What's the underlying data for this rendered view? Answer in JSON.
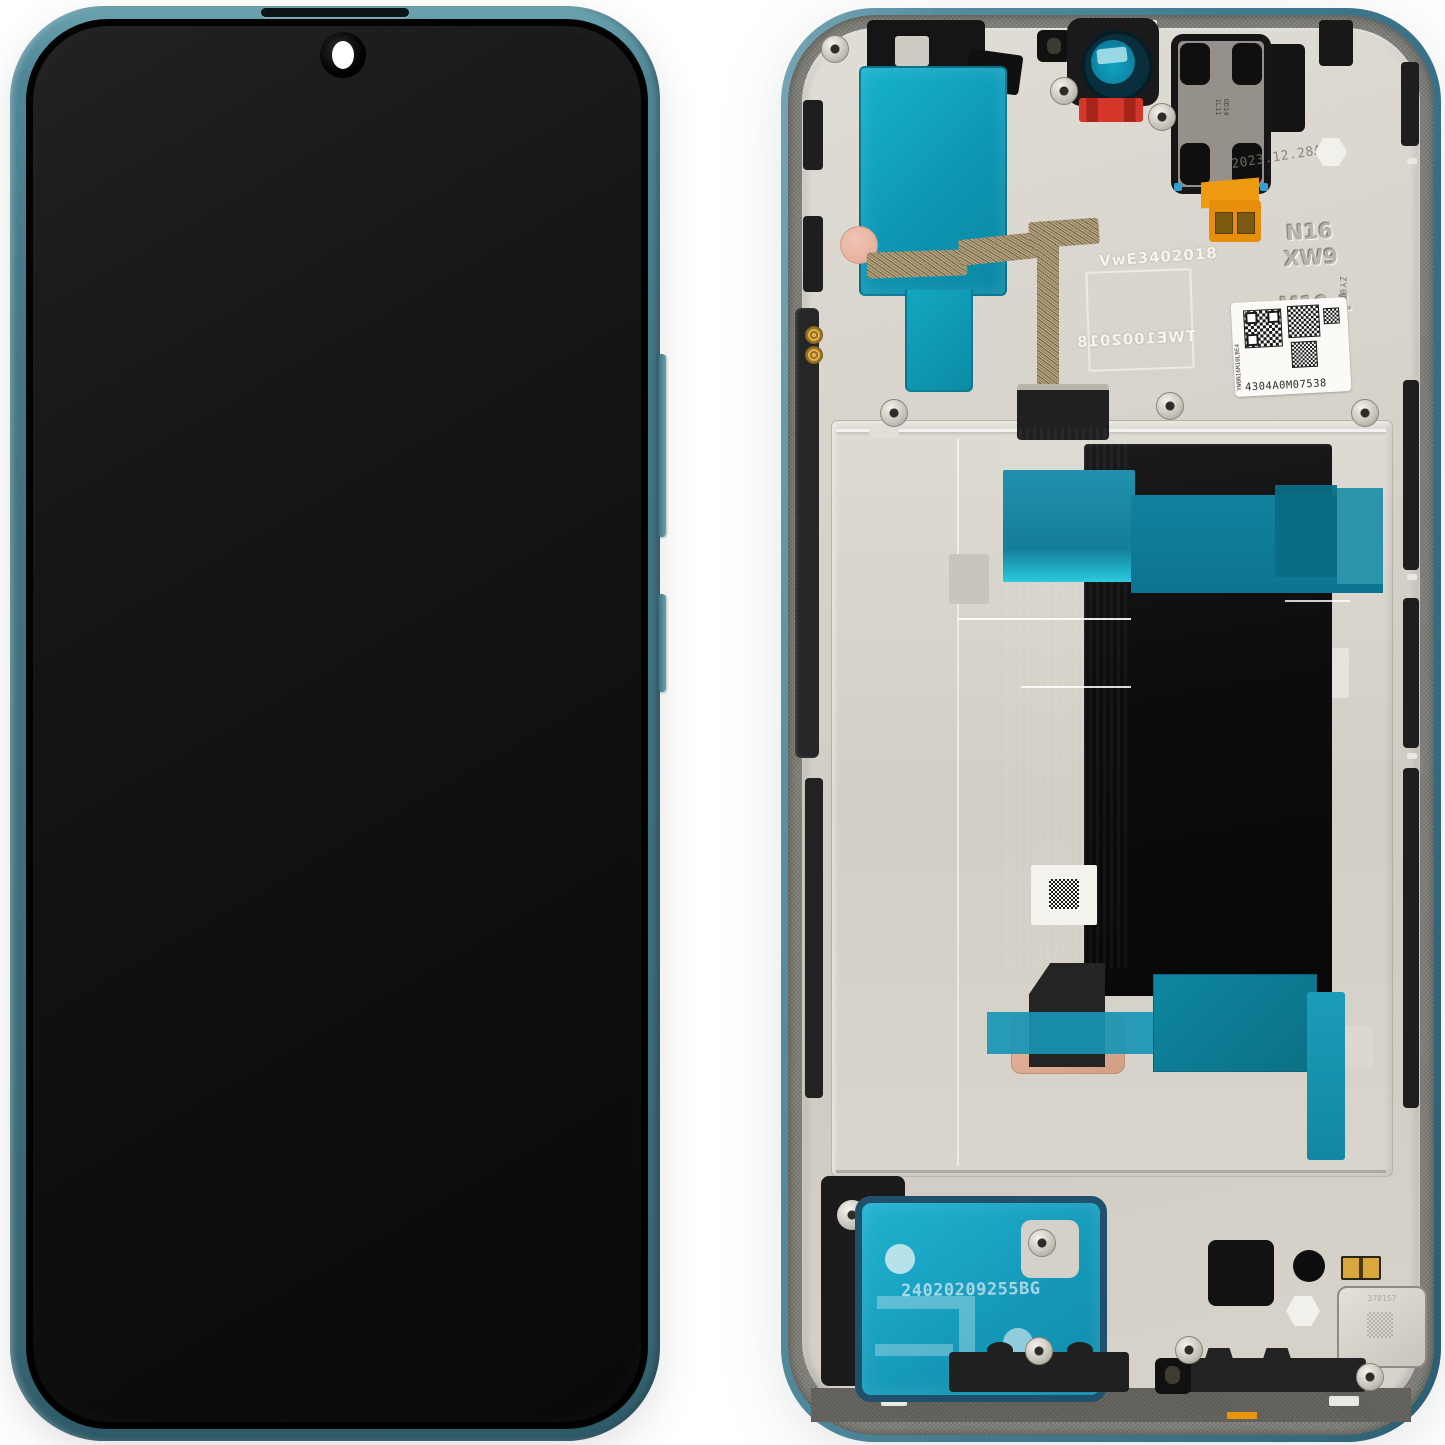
{
  "image": {
    "subject": "Smartphone LCD display assembly with frame, teal color, front and back views",
    "background_color": "#FFFFFF"
  },
  "front_view": {
    "frame_color": "#447583",
    "screen_color": "#0E0E0E",
    "features": [
      "earpiece-slot",
      "punch-hole-camera",
      "volume-button",
      "power-button"
    ]
  },
  "back_view": {
    "markings": {
      "date_stamp": "2023.12.28A",
      "mold_code_line1": "N16",
      "mold_code_line2": "XW9",
      "mold_code_line3": "M10-1",
      "plate_print_top": "VwE3402018",
      "plate_print_bottom_mirrored": "TWE1002018",
      "frame_serial_vertical": "ZY06181272I",
      "qr_sticker_serial": "4304A0M07538",
      "qr_sticker_side_code": "YW0N16M10LBE4",
      "speaker_tape_code": "24020209255BG",
      "earpiece_marking_a": "GD14",
      "earpiece_marking_b": "1L11",
      "vibration_motor_marking": "3701S7"
    },
    "colors": {
      "rim_teal": "#417A90",
      "mid_frame_grey": "#807F79",
      "plate_silver": "#D6D2CA",
      "adhesive_teal_top": "#0FA7C4",
      "adhesive_teal_band": "#10829E",
      "speaker_tape_teal": "#1598B8",
      "tape_border_navy": "#20506B",
      "copper_pad": "#D9A88F",
      "red_clip": "#D6352A",
      "orange_flex": "#EF9B12",
      "flex_black": "#232323"
    }
  }
}
